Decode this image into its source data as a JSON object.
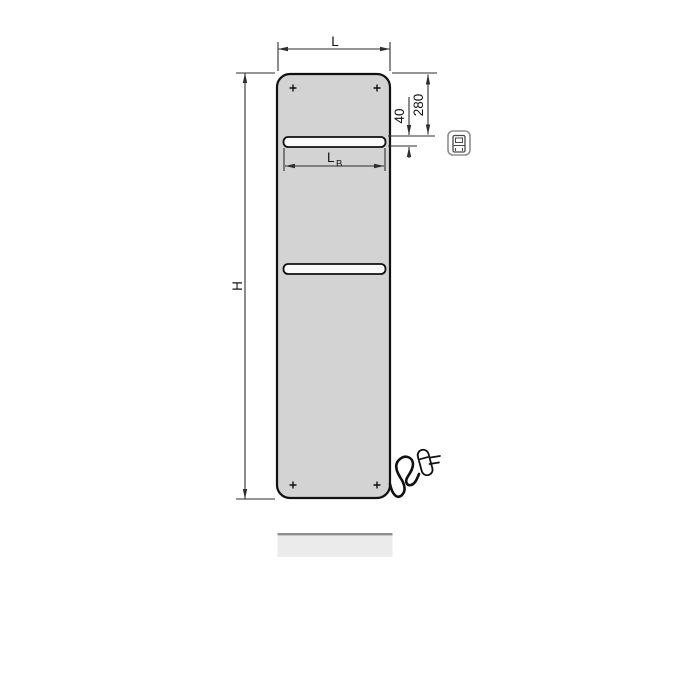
{
  "drawing": {
    "type": "product-dimension-diagram",
    "subject": "flat panel electric radiator with two towel bars, power cord and plug",
    "labels": {
      "width": "L",
      "height": "H",
      "bar_width_main": "L",
      "bar_width_sub": "B",
      "top_offset": "280",
      "bar_thickness": "40"
    },
    "icons": {
      "control_unit": "control-unit-icon",
      "power_plug": "power-plug-icon",
      "screw_marks": "screw-cross-mark"
    }
  },
  "colors": {
    "background": "#ffffff",
    "panel_fill": "#d3d3d3",
    "bar_fill": "#fafafa",
    "outline": "#111111",
    "dimension_line": "#2e2e2e",
    "reflection_fill": "#ebebeb",
    "reflection_edge": "#8f8f8f",
    "icon_outline": "#8f8f8f"
  }
}
